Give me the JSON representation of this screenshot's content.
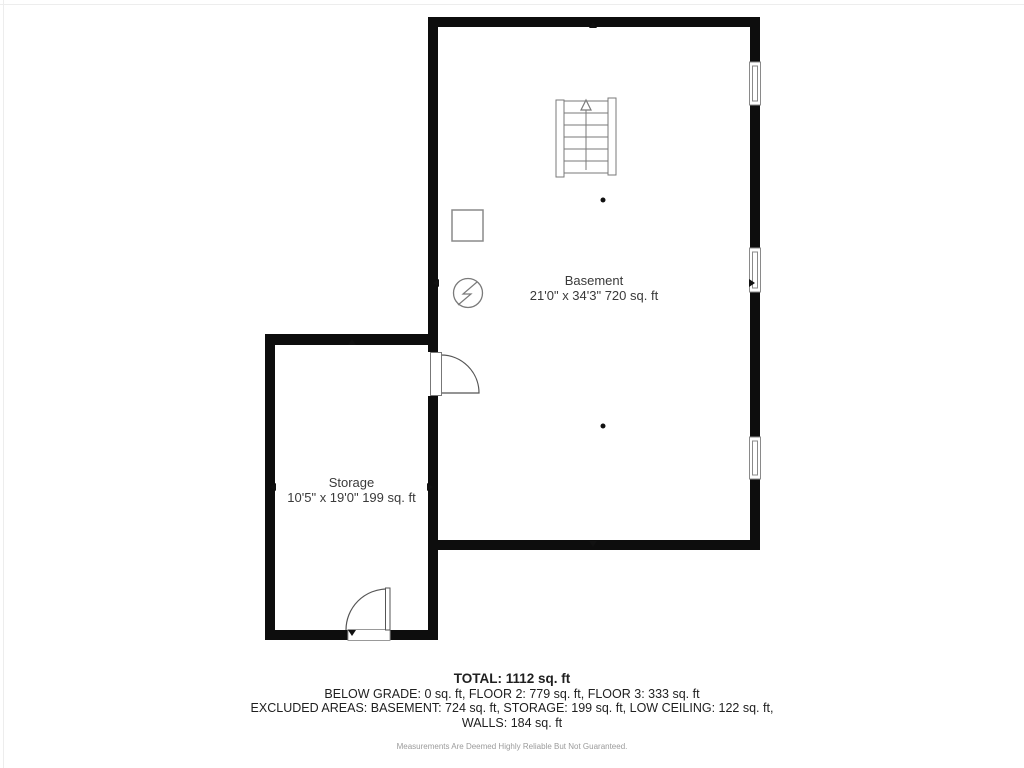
{
  "floor_plan": {
    "rooms": [
      {
        "name": "Basement",
        "dimensions": "21'0\" x 34'3\" 720 sq. ft"
      },
      {
        "name": "Storage",
        "dimensions": "10'5\" x 19'0\" 199 sq. ft"
      }
    ],
    "symbols": [
      {
        "name": "staircase-up-icon",
        "meaning": "staircase with up-direction arrow"
      },
      {
        "name": "electrical-panel-icon",
        "meaning": "circle with lightning bolt"
      },
      {
        "name": "utility-box-icon",
        "meaning": "small square fixture outline"
      },
      {
        "name": "window-icon",
        "meaning": "double-line window in wall",
        "count": 3
      },
      {
        "name": "door-swing-icon",
        "meaning": "door leaf with quarter-circle swing arc",
        "count": 2
      },
      {
        "name": "scan-point-dot",
        "meaning": "small black dot marker",
        "count": 2
      },
      {
        "name": "dimension-arrow",
        "meaning": "small black triangle extent marker",
        "count": 8
      }
    ],
    "colors": {
      "wall": "#0d0d0d",
      "fixture_outline": "#7a7a7a",
      "label_text": "#3a3a3a"
    }
  },
  "summary": {
    "total": "TOTAL: 1112 sq. ft",
    "lines": [
      "BELOW GRADE: 0 sq. ft, FLOOR 2: 779 sq. ft, FLOOR 3: 333 sq. ft",
      "EXCLUDED AREAS: BASEMENT: 724 sq. ft, STORAGE: 199 sq. ft, LOW CEILING: 122 sq. ft,",
      "WALLS: 184 sq. ft"
    ],
    "disclaimer": "Measurements Are Deemed Highly Reliable But Not Guaranteed."
  }
}
